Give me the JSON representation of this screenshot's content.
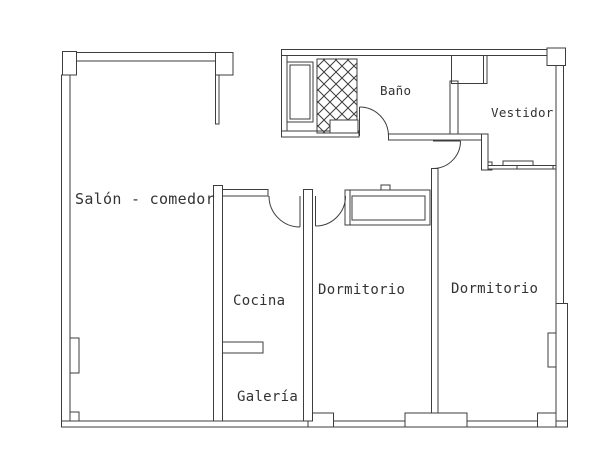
{
  "plan": {
    "background": "#ffffff",
    "line_color": "#3d3d3d",
    "text_color": "#333333",
    "rooms": {
      "salon": {
        "label": "Salón - comedor"
      },
      "bano": {
        "label": "Baño"
      },
      "vestidor": {
        "label": "Vestidor"
      },
      "cocina": {
        "label": "Cocina"
      },
      "dormitorio1": {
        "label": "Dormitorio"
      },
      "dormitorio2": {
        "label": "Dormitorio"
      },
      "galeria": {
        "label": "Galería"
      }
    },
    "symbols": {
      "shower": "crosshatch-shower-tray",
      "bath_fixture": "bathtub-cabinet",
      "wardrobe": "built-in-wardrobe",
      "sliding_door": "sliding-door-panels",
      "swing_doors": "quarter-arc-door-swings"
    }
  }
}
